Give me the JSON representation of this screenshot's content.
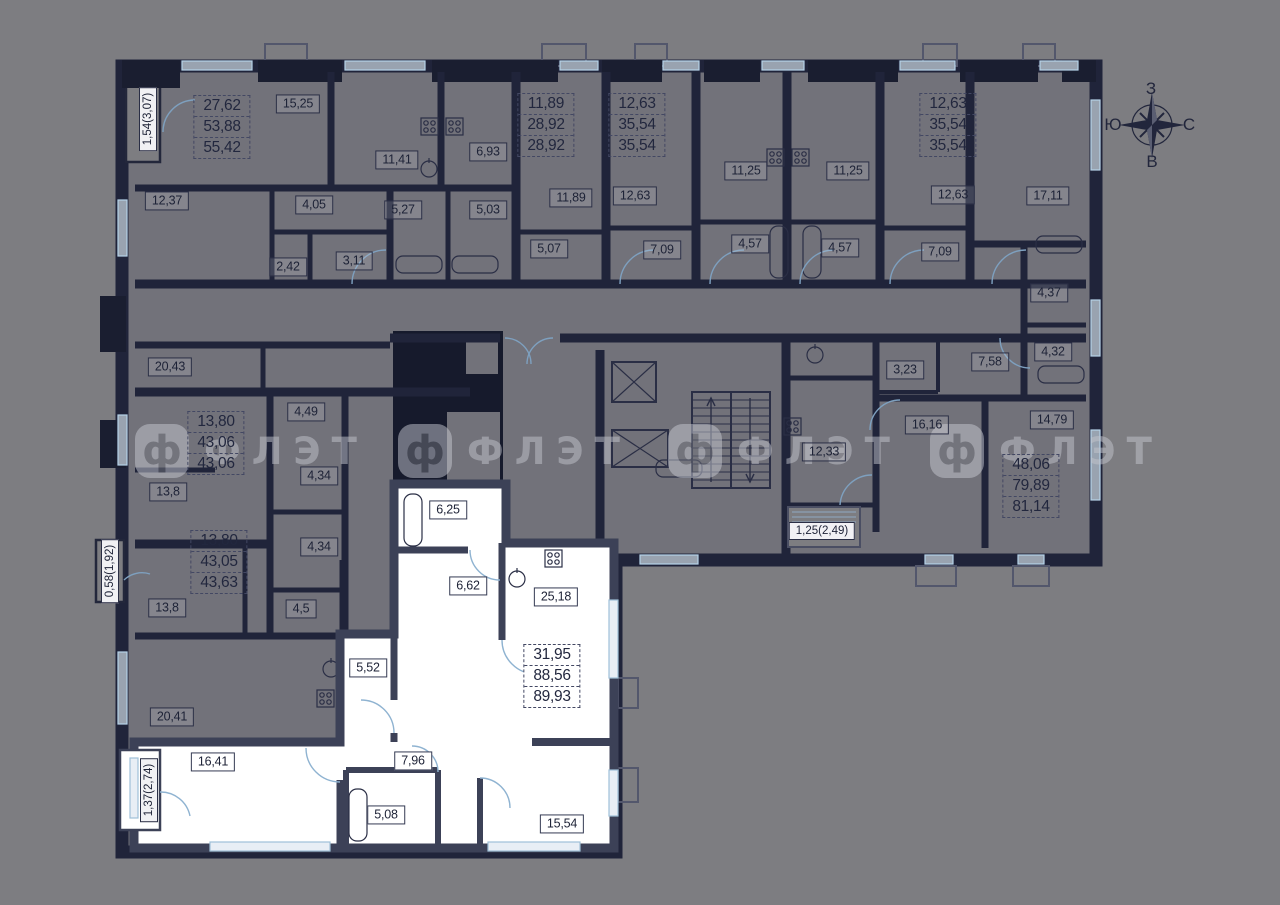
{
  "compass": {
    "top": "З",
    "left": "Ю",
    "right": "С",
    "bottom": "В"
  },
  "watermark": {
    "logo_letter": "ф",
    "text": "ФЛЭТ"
  },
  "colors": {
    "background": "#7d7d81",
    "room_fill": "#72727a",
    "wall_dark": "#20243a",
    "shaft_black": "#161a2c",
    "selected_fill": "#ffffff",
    "selected_wall": "#3c4157",
    "window_line": "#9fc0d8",
    "label_ink": "#1d2236"
  },
  "apartments": [
    {
      "area_lines": [
        "27,62",
        "53,88",
        "55,42"
      ],
      "selected": false
    },
    {
      "area_lines": [
        "11,89",
        "28,92",
        "28,92"
      ],
      "selected": false
    },
    {
      "area_lines": [
        "12,63",
        "35,54",
        "35,54"
      ],
      "selected": false
    },
    {
      "area_lines": [
        "12,63",
        "35,54",
        "35,54"
      ],
      "selected": false
    },
    {
      "area_lines": [
        "13,80",
        "43,06",
        "43,06"
      ],
      "selected": false
    },
    {
      "area_lines": [
        "13,80",
        "43,05",
        "43,63"
      ],
      "selected": false
    },
    {
      "area_lines": [
        "48,06",
        "79,89",
        "81,14"
      ],
      "selected": false
    },
    {
      "area_lines": [
        "31,95",
        "88,56",
        "89,93"
      ],
      "selected": true
    }
  ],
  "rooms": [
    {
      "value": "15,25"
    },
    {
      "value": "11,41"
    },
    {
      "value": "6,93"
    },
    {
      "value": "12,37"
    },
    {
      "value": "4,05"
    },
    {
      "value": "5,27"
    },
    {
      "value": "5,03"
    },
    {
      "value": "2,42"
    },
    {
      "value": "3,11"
    },
    {
      "value": "11,89"
    },
    {
      "value": "5,07"
    },
    {
      "value": "12,63"
    },
    {
      "value": "7,09"
    },
    {
      "value": "11,25"
    },
    {
      "value": "4,57"
    },
    {
      "value": "11,25"
    },
    {
      "value": "4,57"
    },
    {
      "value": "12,63"
    },
    {
      "value": "7,09"
    },
    {
      "value": "17,11"
    },
    {
      "value": "4,37"
    },
    {
      "value": "7,58"
    },
    {
      "value": "4,32"
    },
    {
      "value": "3,23"
    },
    {
      "value": "16,16"
    },
    {
      "value": "14,79"
    },
    {
      "value": "12,33"
    },
    {
      "value": "20,43"
    },
    {
      "value": "4,49"
    },
    {
      "value": "4,34"
    },
    {
      "value": "13,8"
    },
    {
      "value": "4,34"
    },
    {
      "value": "13,8"
    },
    {
      "value": "4,5"
    },
    {
      "value": "20,41"
    },
    {
      "value": "6,25"
    },
    {
      "value": "6,62"
    },
    {
      "value": "25,18"
    },
    {
      "value": "5,52"
    },
    {
      "value": "16,41"
    },
    {
      "value": "7,96"
    },
    {
      "value": "5,08"
    },
    {
      "value": "15,54"
    }
  ],
  "dimensions": [
    {
      "value": "1,54(3,07)",
      "orientation": "vertical"
    },
    {
      "value": "0,58(1,92)",
      "orientation": "vertical"
    },
    {
      "value": "1,37(2,74)",
      "orientation": "vertical"
    },
    {
      "value": "1,25(2,49)",
      "orientation": "horizontal"
    }
  ]
}
